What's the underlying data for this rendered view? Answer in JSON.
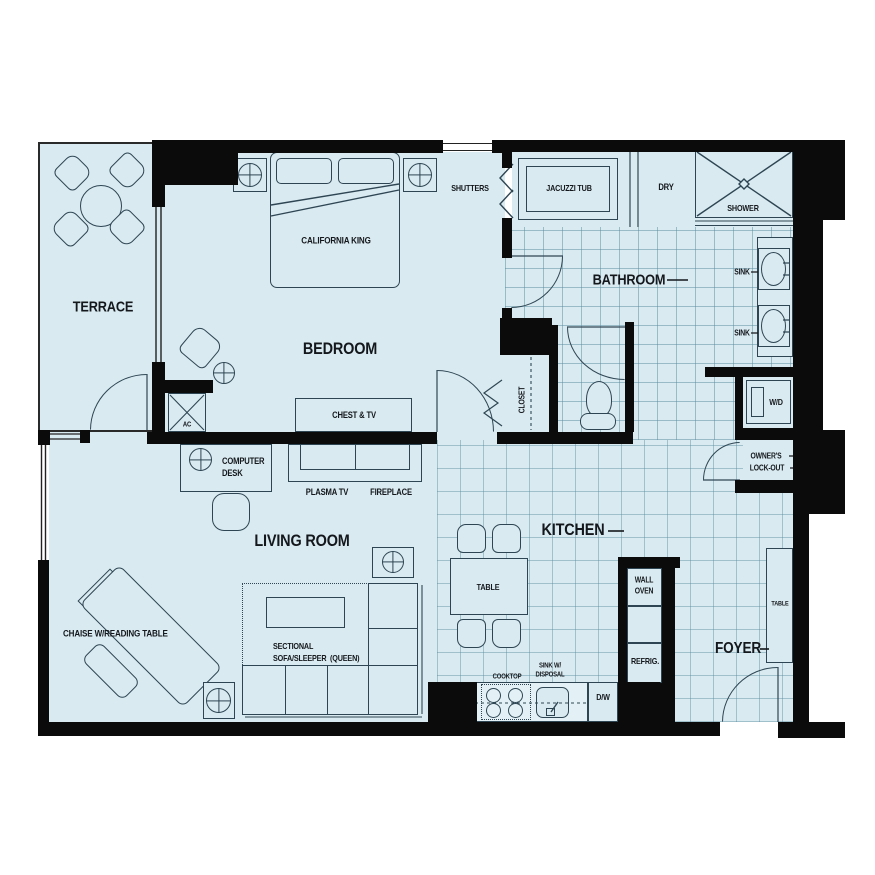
{
  "colors": {
    "floor": "#d9eaf1",
    "wall": "#0b0b0b",
    "line": "#2e4653",
    "tile_line": "#9fc3d2"
  },
  "rooms": {
    "terrace": "TERRACE",
    "bedroom": "BEDROOM",
    "bathroom": "BATHROOM",
    "living_room": "LIVING ROOM",
    "kitchen": "KITCHEN",
    "foyer": "FOYER"
  },
  "bedroom": {
    "bed": "CALIFORNIA KING",
    "chest": "CHEST & TV",
    "shutters": "SHUTTERS",
    "ac": "AC"
  },
  "bathroom": {
    "jacuzzi": "JACUZZI TUB",
    "dry": "DRY",
    "shower": "SHOWER",
    "sink_upper": "SINK",
    "sink_lower": "SINK",
    "closet": "CLOSET",
    "washer_dryer": "W/D",
    "owners_lockout_line1": "OWNER'S",
    "owners_lockout_line2": "LOCK-OUT"
  },
  "living": {
    "computer_desk_line1": "COMPUTER",
    "computer_desk_line2": "DESK",
    "plasma_tv": "PLASMA TV",
    "fireplace": "FIREPLACE",
    "chaise": "CHAISE W/READING TABLE",
    "sectional_line1": "SECTIONAL",
    "sectional_line2": "SOFA/SLEEPER  (QUEEN)"
  },
  "kitchen": {
    "table": "TABLE",
    "wall_oven_line1": "WALL",
    "wall_oven_line2": "OVEN",
    "refrigerator": "REFRIG.",
    "cooktop": "COOKTOP",
    "sink_line1": "SINK W/",
    "sink_line2": "DISPOSAL",
    "dishwasher": "D/W"
  },
  "foyer": {
    "console_table": "TABLE"
  }
}
